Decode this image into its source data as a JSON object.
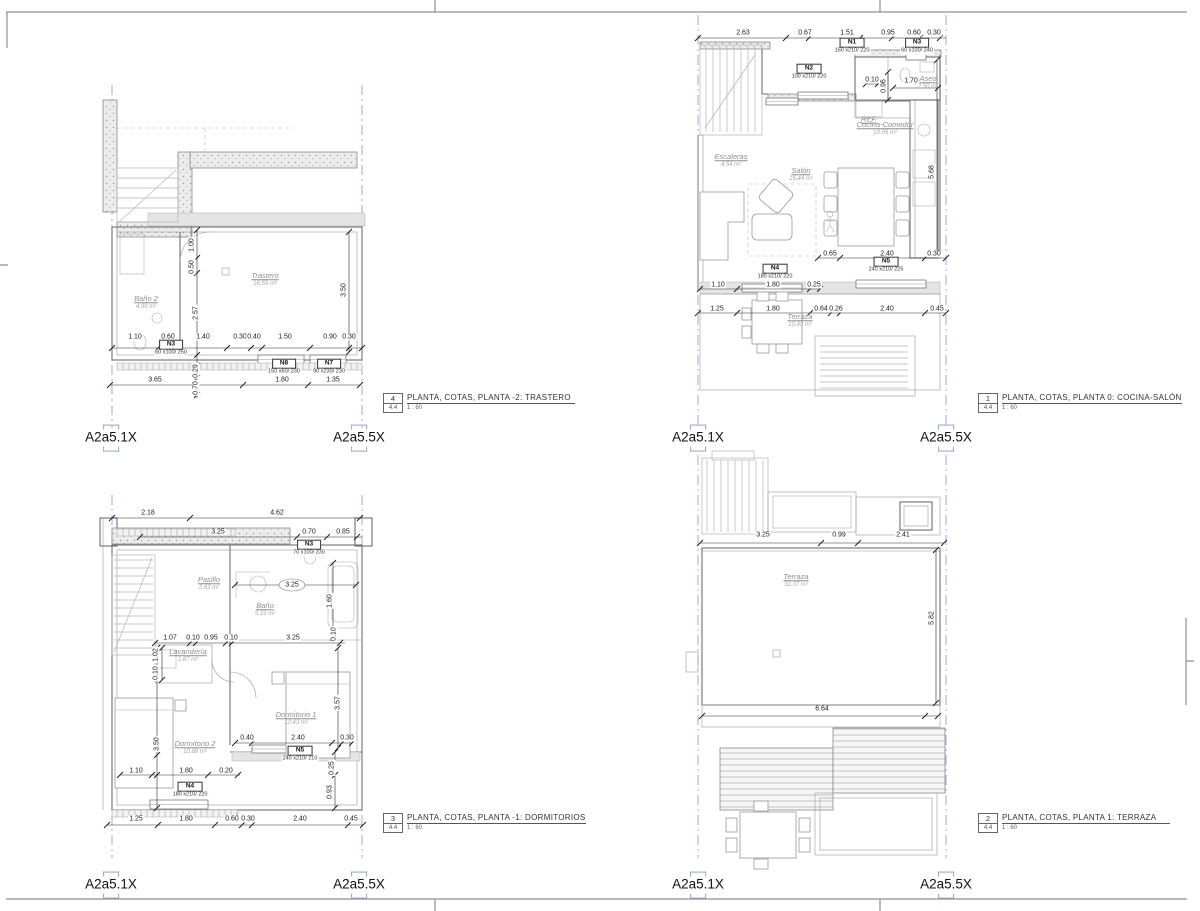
{
  "sheet": {
    "drawing_type": "PLANTA, COTAS",
    "scale": "1 : 60",
    "colors": {
      "grid_line": "#8c8cf0",
      "wall": "#707070",
      "dimension_text": "#1a1a1a",
      "room_label": "#8f8f8f",
      "concrete_fill": "#ececec"
    }
  },
  "grid_labels": [
    {
      "text": "A2a5.1X",
      "x": 111,
      "y": 438
    },
    {
      "text": "A2a5.5X",
      "x": 359,
      "y": 438
    },
    {
      "text": "A2a5.1X",
      "x": 698,
      "y": 438
    },
    {
      "text": "A2a5.5X",
      "x": 946,
      "y": 438
    },
    {
      "text": "A2a5.1X",
      "x": 111,
      "y": 885
    },
    {
      "text": "A2a5.5X",
      "x": 359,
      "y": 885
    },
    {
      "text": "A2a5.1X",
      "x": 698,
      "y": 885
    },
    {
      "text": "A2a5.5X",
      "x": 946,
      "y": 885
    }
  ],
  "plans": [
    {
      "id": "trastero",
      "caption": {
        "number": "4",
        "detail": "4.4",
        "title": "PLANTA, COTAS, PLANTA -2: TRASTERO",
        "scale": "1 : 60"
      },
      "rooms": [
        {
          "name": "Baño 2",
          "area": "4.99 m²",
          "x": 146,
          "y": 303
        },
        {
          "name": "Trastero",
          "area": "16.59 m²",
          "x": 265,
          "y": 280
        }
      ],
      "tags": [
        {
          "label": "N3",
          "size": "60 x100/ 250",
          "x": 171,
          "y": 348
        },
        {
          "label": "N8",
          "size": "150 x60/ 230",
          "x": 284,
          "y": 367
        },
        {
          "label": "N7",
          "size": "90 x230/ 230",
          "x": 329,
          "y": 367
        }
      ],
      "dims": [
        {
          "text": "1.10",
          "x": 135,
          "y": 337
        },
        {
          "text": "0.60",
          "x": 168,
          "y": 337
        },
        {
          "text": "1.40",
          "x": 203,
          "y": 337
        },
        {
          "text": "0.30",
          "x": 240,
          "y": 337
        },
        {
          "text": "0.40",
          "x": 254,
          "y": 337
        },
        {
          "text": "1.50",
          "x": 285,
          "y": 337
        },
        {
          "text": "0.90",
          "x": 330,
          "y": 337
        },
        {
          "text": "0.30",
          "x": 349,
          "y": 337
        },
        {
          "text": "3.65",
          "x": 155,
          "y": 380
        },
        {
          "text": "1.80",
          "x": 282,
          "y": 380
        },
        {
          "text": "1.35",
          "x": 333,
          "y": 380
        },
        {
          "text": "1.00",
          "x": 192,
          "y": 245,
          "rot": -90
        },
        {
          "text": "0.50",
          "x": 192,
          "y": 267,
          "rot": -90
        },
        {
          "text": "2.57",
          "x": 196,
          "y": 313,
          "rot": -90
        },
        {
          "text": "0.29",
          "x": 196,
          "y": 371,
          "rot": -90
        },
        {
          "text": "0.70",
          "x": 196,
          "y": 388,
          "rot": -90
        },
        {
          "text": "3.50",
          "x": 344,
          "y": 290,
          "rot": -90
        }
      ]
    },
    {
      "id": "cocina-salon",
      "caption": {
        "number": "1",
        "detail": "4.4",
        "title": "PLANTA, COTAS, PLANTA 0: COCINA-SALÓN",
        "scale": "1 : 60"
      },
      "rooms": [
        {
          "name": "REF.",
          "area": "",
          "x": 869,
          "y": 120
        },
        {
          "name": "Cocina-Comedor",
          "area": "19.95 m²",
          "x": 885,
          "y": 129
        },
        {
          "name": "Escaleras",
          "area": "4.54 m²",
          "x": 731,
          "y": 161
        },
        {
          "name": "Salón",
          "area": "16.44 m²",
          "x": 801,
          "y": 175
        },
        {
          "name": "Aseo",
          "area": "2.50 m²",
          "x": 928,
          "y": 83
        },
        {
          "name": "Terraza",
          "area": "10.43 m²",
          "x": 800,
          "y": 321
        }
      ],
      "tags": [
        {
          "label": "N1",
          "size": "150 x210/ 220",
          "x": 852,
          "y": 46
        },
        {
          "label": "N3",
          "size": "60 x100/ 240",
          "x": 917,
          "y": 46
        },
        {
          "label": "N2",
          "size": "100 x210/ 220",
          "x": 809,
          "y": 72
        },
        {
          "label": "N5",
          "size": "240 x210/ 225",
          "x": 886,
          "y": 265
        },
        {
          "label": "N4",
          "size": "180 x210/ 220",
          "x": 775,
          "y": 272
        }
      ],
      "dims": [
        {
          "text": "2.63",
          "x": 743,
          "y": 33
        },
        {
          "text": "0.67",
          "x": 805,
          "y": 33
        },
        {
          "text": "1.51",
          "x": 847,
          "y": 33
        },
        {
          "text": "0.95",
          "x": 888,
          "y": 33
        },
        {
          "text": "0.60",
          "x": 914,
          "y": 33
        },
        {
          "text": "0.30",
          "x": 934,
          "y": 33
        },
        {
          "text": "0.10",
          "x": 872,
          "y": 80
        },
        {
          "text": "0.96",
          "x": 884,
          "y": 86,
          "rot": -90
        },
        {
          "text": "1.70",
          "x": 911,
          "y": 81
        },
        {
          "text": "0.65",
          "x": 830,
          "y": 254
        },
        {
          "text": "2.40",
          "x": 887,
          "y": 254
        },
        {
          "text": "0.30",
          "x": 934,
          "y": 254
        },
        {
          "text": "1.10",
          "x": 718,
          "y": 285
        },
        {
          "text": "1.80",
          "x": 773,
          "y": 285
        },
        {
          "text": "0.25",
          "x": 814,
          "y": 285
        },
        {
          "text": "1.25",
          "x": 717,
          "y": 309
        },
        {
          "text": "1.80",
          "x": 773,
          "y": 309
        },
        {
          "text": "0.64",
          "x": 821,
          "y": 309
        },
        {
          "text": "0.26",
          "x": 836,
          "y": 309
        },
        {
          "text": "2.40",
          "x": 887,
          "y": 309
        },
        {
          "text": "0.45",
          "x": 937,
          "y": 309
        },
        {
          "text": "5.68",
          "x": 932,
          "y": 172,
          "rot": -90
        }
      ]
    },
    {
      "id": "dormitorios",
      "caption": {
        "number": "3",
        "detail": "4.4",
        "title": "PLANTA, COTAS, PLANTA -1: DORMITORIOS",
        "scale": "1 : 60"
      },
      "rooms": [
        {
          "name": "Pasillo",
          "area": "2.63 m²",
          "x": 209,
          "y": 584
        },
        {
          "name": "Baño",
          "area": "5.19 m²",
          "x": 265,
          "y": 610
        },
        {
          "name": "Lavandería",
          "area": "1.87 m²",
          "x": 188,
          "y": 656
        },
        {
          "name": "Dormitorio 1",
          "area": "12.43 m²",
          "x": 296,
          "y": 719
        },
        {
          "name": "Dormitorio 2",
          "area": "10.88 m²",
          "x": 195,
          "y": 748
        }
      ],
      "tags": [
        {
          "label": "N3",
          "size": "70 x100/ 230",
          "x": 309,
          "y": 548
        },
        {
          "label": "N5",
          "size": "240 x210/ 210",
          "x": 300,
          "y": 754
        },
        {
          "label": "N4",
          "size": "180 x210/ 220",
          "x": 190,
          "y": 790
        }
      ],
      "dims": [
        {
          "text": "2.18",
          "x": 148,
          "y": 513
        },
        {
          "text": "4.62",
          "x": 277,
          "y": 513
        },
        {
          "text": "3.25",
          "x": 218,
          "y": 532
        },
        {
          "text": "0.70",
          "x": 309,
          "y": 532
        },
        {
          "text": "0.85",
          "x": 343,
          "y": 532
        },
        {
          "text": "3.25",
          "x": 292,
          "y": 585
        },
        {
          "text": "1.60",
          "x": 330,
          "y": 601,
          "rot": -90
        },
        {
          "text": "1.07",
          "x": 170,
          "y": 638
        },
        {
          "text": "0.10",
          "x": 193,
          "y": 638
        },
        {
          "text": "0.95",
          "x": 211,
          "y": 638
        },
        {
          "text": "0.10",
          "x": 231,
          "y": 638
        },
        {
          "text": "3.25",
          "x": 293,
          "y": 638
        },
        {
          "text": "0.10",
          "x": 334,
          "y": 634,
          "rot": -90
        },
        {
          "text": "1.02",
          "x": 156,
          "y": 655,
          "rot": -90
        },
        {
          "text": "0.10",
          "x": 156,
          "y": 673,
          "rot": -90
        },
        {
          "text": "3.57",
          "x": 338,
          "y": 703,
          "rot": -90
        },
        {
          "text": "3.50",
          "x": 157,
          "y": 744,
          "rot": -90
        },
        {
          "text": "0.40",
          "x": 247,
          "y": 738
        },
        {
          "text": "2.40",
          "x": 298,
          "y": 738
        },
        {
          "text": "0.30",
          "x": 347,
          "y": 738
        },
        {
          "text": "1.10",
          "x": 136,
          "y": 771
        },
        {
          "text": "1.80",
          "x": 186,
          "y": 771
        },
        {
          "text": "0.20",
          "x": 226,
          "y": 771
        },
        {
          "text": "0.25",
          "x": 332,
          "y": 768,
          "rot": -90
        },
        {
          "text": "0.93",
          "x": 330,
          "y": 792,
          "rot": -90
        },
        {
          "text": "1.25",
          "x": 136,
          "y": 819
        },
        {
          "text": "1.80",
          "x": 186,
          "y": 819
        },
        {
          "text": "0.60",
          "x": 232,
          "y": 819
        },
        {
          "text": "0.30",
          "x": 248,
          "y": 819
        },
        {
          "text": "2.40",
          "x": 300,
          "y": 819
        },
        {
          "text": "0.45",
          "x": 351,
          "y": 819
        }
      ]
    },
    {
      "id": "terraza",
      "caption": {
        "number": "2",
        "detail": "4.4",
        "title": "PLANTA, COTAS, PLANTA 1: TERRAZA",
        "scale": "1 : 60"
      },
      "rooms": [
        {
          "name": "Terraza",
          "area": "32.37 m²",
          "x": 796,
          "y": 581
        }
      ],
      "tags": [],
      "dims": [
        {
          "text": "3.25",
          "x": 763,
          "y": 535
        },
        {
          "text": "0.99",
          "x": 839,
          "y": 535
        },
        {
          "text": "2.41",
          "x": 903,
          "y": 535
        },
        {
          "text": "5.82",
          "x": 932,
          "y": 618,
          "rot": -90
        },
        {
          "text": "6.64",
          "x": 822,
          "y": 709
        }
      ]
    }
  ]
}
